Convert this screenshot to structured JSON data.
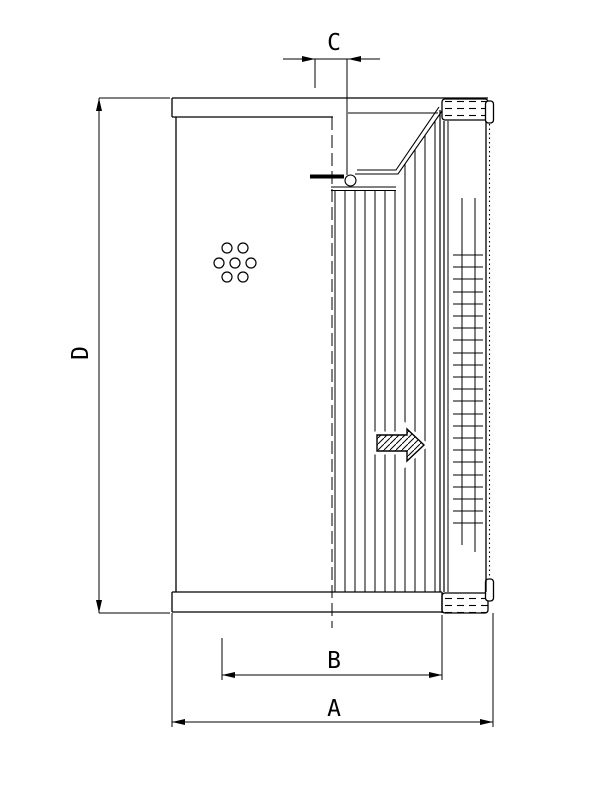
{
  "drawing": {
    "dimensions": {
      "overall_width": {
        "label": "A"
      },
      "element_width": {
        "label": "B"
      },
      "top_opening": {
        "label": "C"
      },
      "height": {
        "label": "D"
      }
    },
    "icons": {
      "flow_arrow": "right-block-arrow"
    },
    "colors": {
      "line": "#000000",
      "background": "#ffffff"
    }
  }
}
